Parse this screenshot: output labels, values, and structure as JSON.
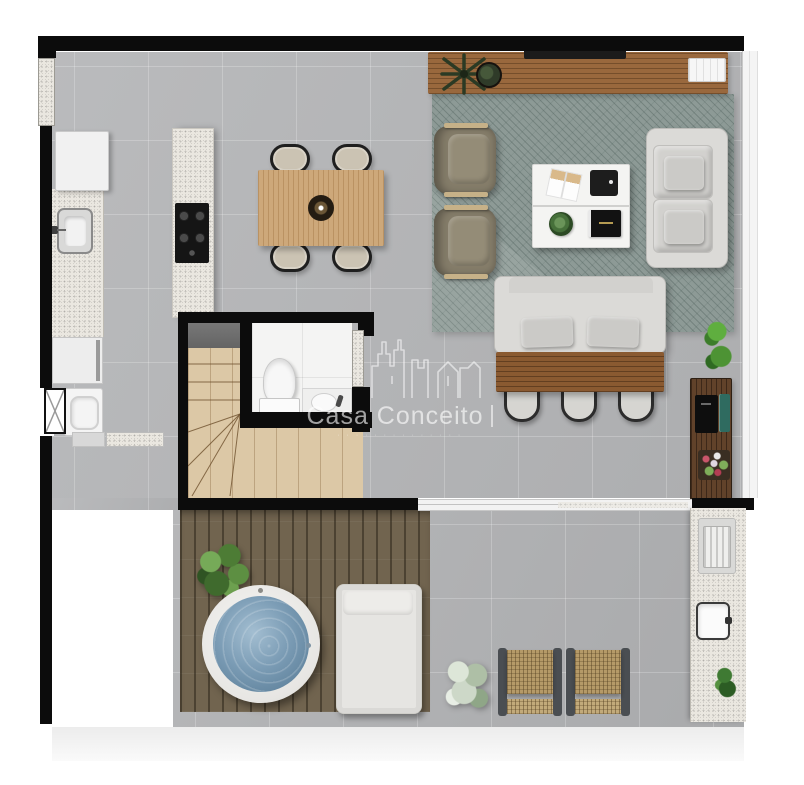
{
  "watermark": {
    "logo_icon": "city-skyline-outline-icon",
    "brand": "Casa Conceito",
    "separator": "|",
    "tagline_dots": "· · · · · · · · · · · · · ·"
  },
  "palette": {
    "wall": "#0c0c0c",
    "interior_tile": "#b6b7b9",
    "deck_wood": "#71644f",
    "stair_wood": "#dcc8a6",
    "dining_table_wood": "#cda87a",
    "console_wood": "#99683d",
    "rear_table_wood": "#8a5a31",
    "bar_wood": "#61422a",
    "granite_counter": "#eae7e0",
    "rug_green_gray": "#8d9a96",
    "sofa_gray": "#dbdad7",
    "armchair_olive": "#847c69",
    "wicker_tan": "#b59a68",
    "jacuzzi_water": "#7b9cb5",
    "plant_green": "#4e7d3a",
    "bathroom_white": "#f4f4f3"
  },
  "furniture_legend": [
    "refrigerator",
    "kitchen-counter-sink",
    "oven",
    "washing-machine",
    "entry-door",
    "island-cooktop",
    "dining-table-4-chairs",
    "tv-sideboard",
    "area-rug",
    "armchairs",
    "coffee-table",
    "two-seat-sofa",
    "bench-sofa",
    "rear-dining-table-3-chairs",
    "bar-cabinet",
    "staircase",
    "toilet",
    "bathroom-sink",
    "sliding-glass-door",
    "wood-deck",
    "hot-tub",
    "sun-lounger",
    "wicker-chairs",
    "outdoor-counter",
    "grill",
    "outdoor-sink",
    "plants"
  ]
}
